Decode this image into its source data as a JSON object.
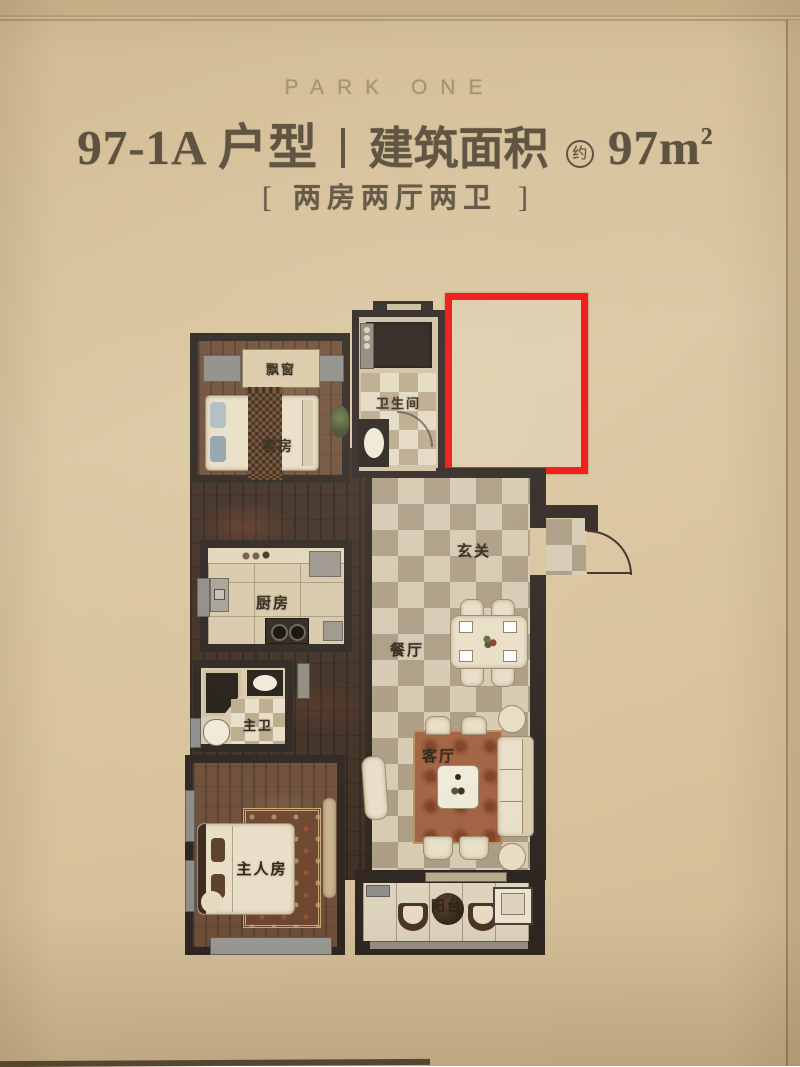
{
  "header": {
    "brand": "PARK ONE",
    "unit_type": "97-1A 户型",
    "area_label": "建筑面积",
    "area_approx": "约",
    "area_value": "97m",
    "area_sup": "2",
    "subtitle_bracket_open": "[",
    "subtitle": "两房两厅两卫",
    "subtitle_bracket_close": "]"
  },
  "floorplan": {
    "labels": {
      "bay_window": "飘窗",
      "guest_room": "客房",
      "bathroom": "卫生间",
      "kitchen": "厨房",
      "hall": "玄关",
      "dining": "餐厅",
      "master_bath": "主卫",
      "living": "客厅",
      "master_bedroom": "主人房",
      "balcony": "阳台"
    },
    "annotation": {
      "shape": "red-rectangle-highlight",
      "color": "#ee1111"
    }
  }
}
